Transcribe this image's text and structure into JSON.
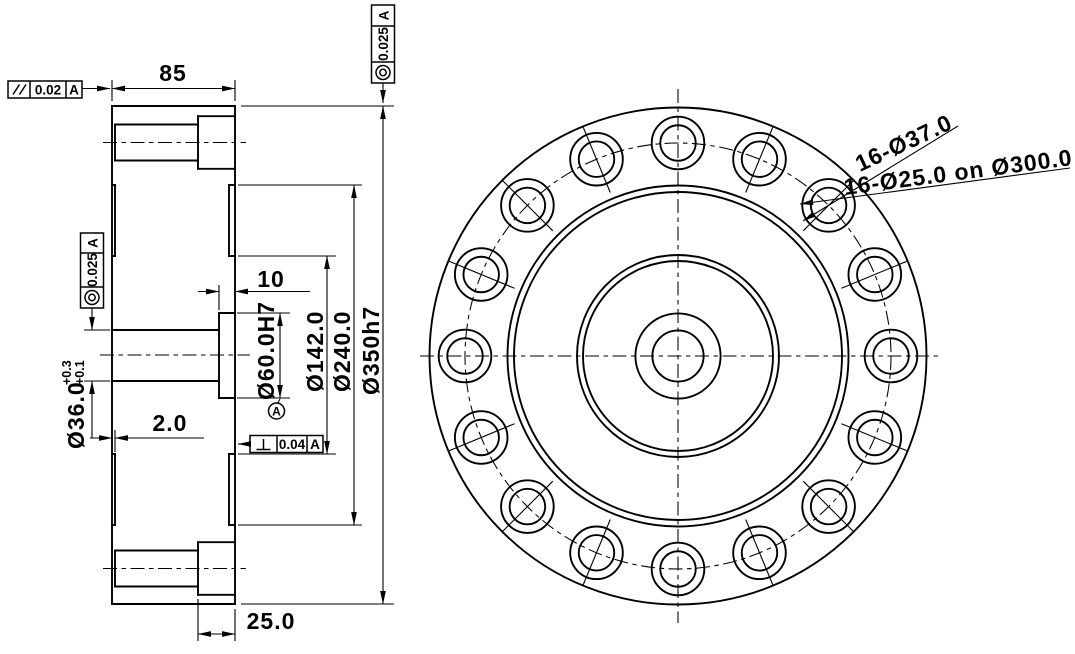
{
  "side_view": {
    "dimensions": {
      "width": "85",
      "hub_recess_depth": "10",
      "face_step": "2.0",
      "counterbore_depth": "25.0",
      "center_bore": {
        "label": "Ø36.0",
        "tol_upper": "+0.3",
        "tol_lower": "+0.1"
      },
      "hub_bore": "Ø60.0H7",
      "inner_dia": "Ø142.0",
      "recess_dia": "Ø240.0",
      "outer_dia": "Ø350h7"
    },
    "gdt": {
      "parallelism": {
        "symbol": "//",
        "value": "0.02",
        "datum": "A"
      },
      "concentricity_bore": {
        "symbol": "◎",
        "value": "0.025",
        "datum": "A"
      },
      "concentricity_od": {
        "symbol": "◎",
        "value": "0.025",
        "datum": "A"
      },
      "perpendicularity": {
        "symbol": "⊥",
        "value": "0.04",
        "datum": "A"
      },
      "datum_feature": "A"
    }
  },
  "front_view": {
    "callouts": {
      "counterbore_holes": "16-Ø37.0",
      "bolt_holes": "16-Ø25.0 on Ø300.0"
    },
    "hole_count": "16"
  },
  "colors": {
    "line": "#000000",
    "background": "#ffffff"
  }
}
